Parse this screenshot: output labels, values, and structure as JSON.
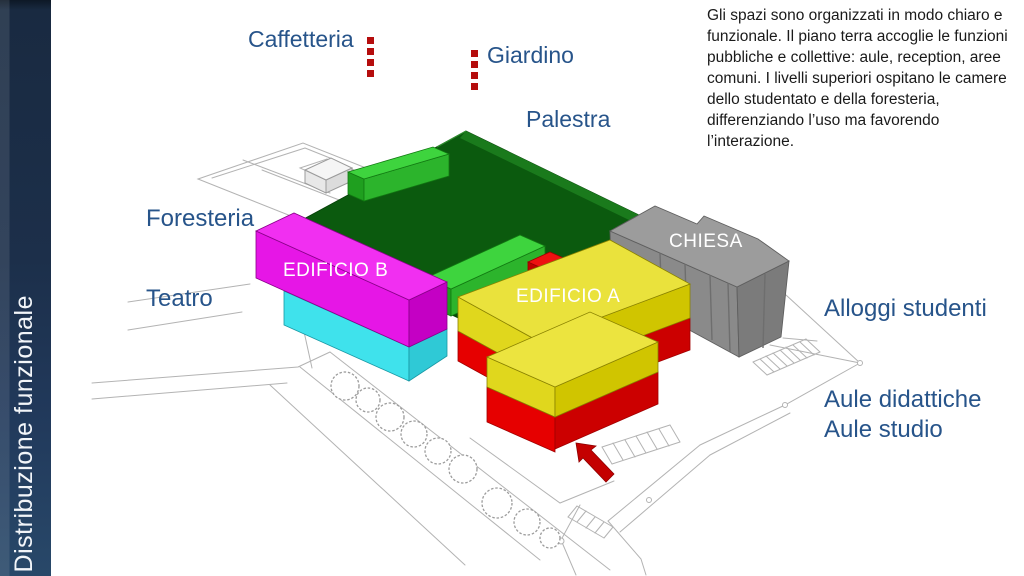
{
  "sidebar": {
    "title": "Distribuzione funzionale"
  },
  "description": "Gli spazi sono organizzati in modo chiaro e funzionale. Il piano terra accoglie le funzioni pubbliche e collettive: aule, reception, aree comuni. I livelli superiori ospitano le camere dello studentato e della foresteria, differenziando l’uso ma favorendo l’interazione.",
  "labels": {
    "caffetteria": "Caffetteria",
    "giardino": "Giardino",
    "palestra": "Palestra",
    "foresteria": "Foresteria",
    "teatro": "Teatro",
    "edificio_b": "EDIFICIO B",
    "edificio_a": "EDIFICIO A",
    "chiesa": "CHIESA",
    "alloggi_studenti": "Alloggi studenti",
    "aule_didattiche": "Aule didattiche",
    "aule_studio": "Aule studio"
  },
  "icons": {
    "caffetteria_divider": "red-dotted-column",
    "giardino_divider": "red-dotted-column",
    "entrance_arrow": "red-arrow-up-left"
  },
  "colors": {
    "sidebar_navy": "#1c2f4a",
    "label_blue": "#27548a",
    "body_text": "#1a1a1a",
    "palestra_dark_green": "#0b5a0e",
    "volume_bright_green": "#3bd43b",
    "edificio_b_magenta": "#e616e6",
    "edificio_b_cyan": "#3fe2ec",
    "edificio_a_yellow": "#eae23c",
    "ground_floor_red": "#e60000",
    "chiesa_gray": "#9c9c9c",
    "divider_red": "#b50d0d",
    "wireframe_gray": "#b3b3b3"
  }
}
